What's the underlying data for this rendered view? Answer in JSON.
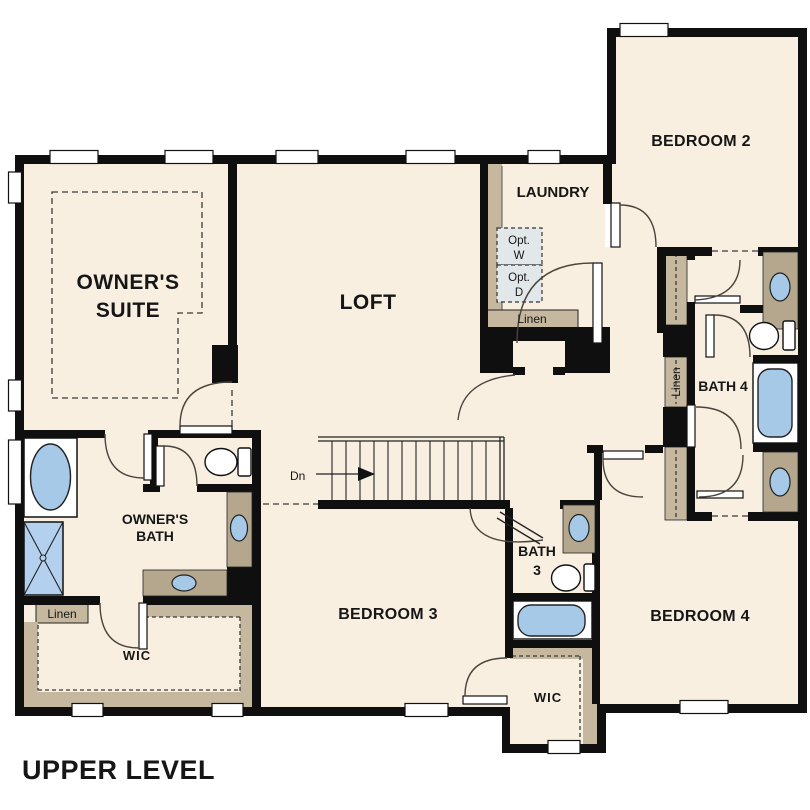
{
  "title": "UPPER LEVEL",
  "colors": {
    "floor": "#f8efe1",
    "wall": "#0f0f0f",
    "shelf_tan": "#c6b89f",
    "vanity_tan": "#b5a78d",
    "fixture_blue": "#a6c9e8",
    "opt_box": "#e2e8ea",
    "background": "#ffffff"
  },
  "rooms": {
    "owners_suite": {
      "line1": "OWNER'S",
      "line2": "SUITE"
    },
    "loft": "LOFT",
    "laundry": "LAUNDRY",
    "bedroom2": "BEDROOM 2",
    "bedroom3": "BEDROOM 3",
    "bedroom4": "BEDROOM 4",
    "owners_bath": {
      "line1": "OWNER'S",
      "line2": "BATH"
    },
    "bath3": {
      "line1": "BATH",
      "line2": "3"
    },
    "bath4": "BATH 4",
    "wic_owner": "WIC",
    "wic_bedroom": "WIC"
  },
  "closets": {
    "linen_owner": "Linen",
    "linen_laundry": "Linen",
    "linen_hall": "Linen"
  },
  "laundry_options": {
    "washer": {
      "line1": "Opt.",
      "line2": "W"
    },
    "dryer": {
      "line1": "Opt.",
      "line2": "D"
    }
  },
  "stairs": {
    "direction_label": "Dn"
  }
}
